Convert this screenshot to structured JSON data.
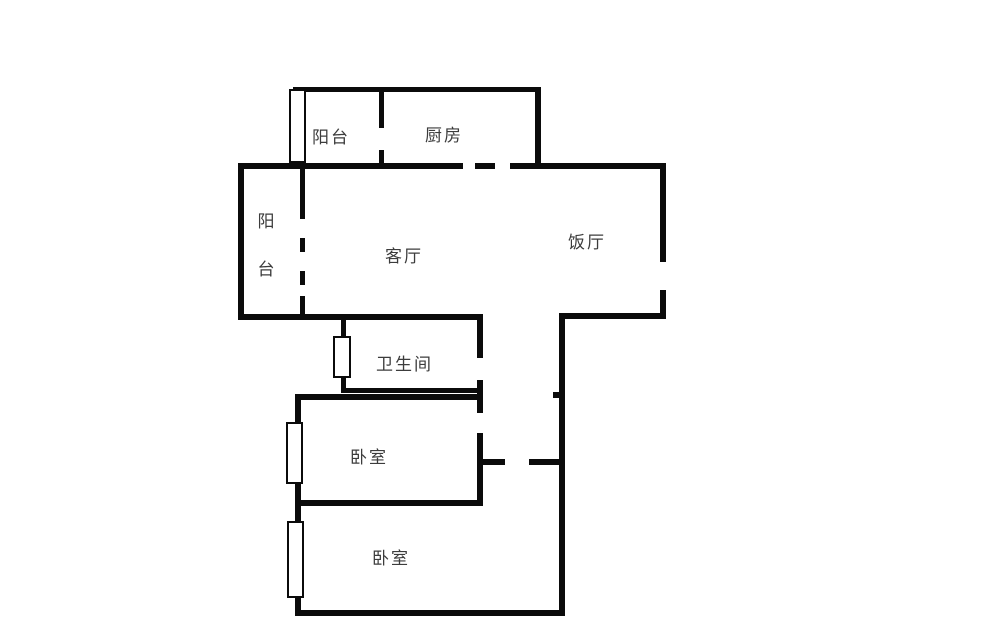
{
  "meta": {
    "type": "apartment-floor-plan",
    "language": "zh-CN"
  },
  "colors": {
    "wall": "#0b0b0b",
    "bg": "#ffffff",
    "label": "#3c3c3c",
    "winfill": "#ffffff"
  },
  "rooms": {
    "balcony_top": {
      "label": "阳台"
    },
    "kitchen": {
      "label": "厨房"
    },
    "balcony_left": {
      "label": "阳台"
    },
    "living_room": {
      "label": "客厅"
    },
    "dining_room": {
      "label": "饭厅"
    },
    "bathroom": {
      "label": "卫生间"
    },
    "bedroom_1": {
      "label": "卧室"
    },
    "bedroom_2": {
      "label": "卧室"
    }
  }
}
